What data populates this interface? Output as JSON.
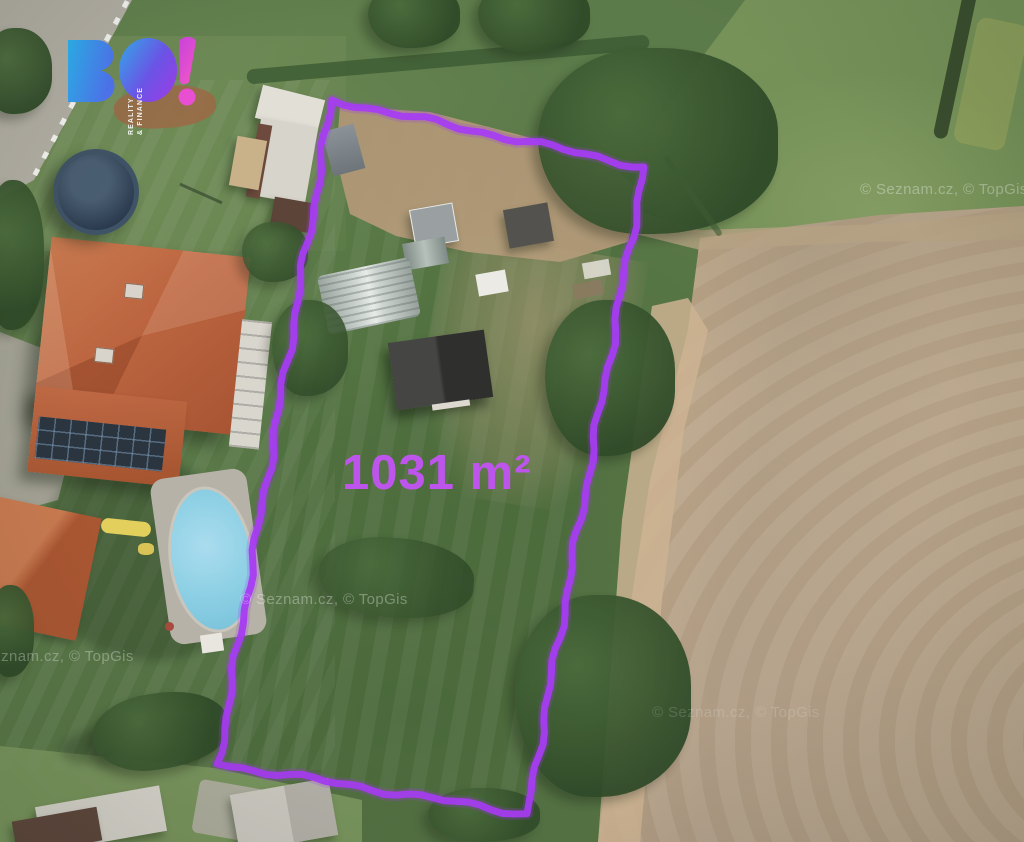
{
  "map": {
    "area_label": "1031 m²",
    "boundary_color": "#a63cf2",
    "label_color": "#bd55ec",
    "plot_corners": [
      [
        332,
        100
      ],
      [
        644,
        167
      ],
      [
        527,
        814
      ],
      [
        218,
        764
      ]
    ]
  },
  "logo": {
    "text": "BO!",
    "tagline_line1": "REALITY",
    "tagline_line2": "& FINANCE",
    "colors": {
      "blue": "#2eb0ee",
      "purple": "#9c3ee8",
      "magenta": "#ee4fd2"
    }
  },
  "watermarks": [
    {
      "text": "© Seznam.cz, © TopGis"
    },
    {
      "text": "© Seznam.cz, © TopGis"
    },
    {
      "text": "Seznam.cz, © TopGis"
    },
    {
      "text": "© Seznam.cz, © TopGis"
    }
  ]
}
